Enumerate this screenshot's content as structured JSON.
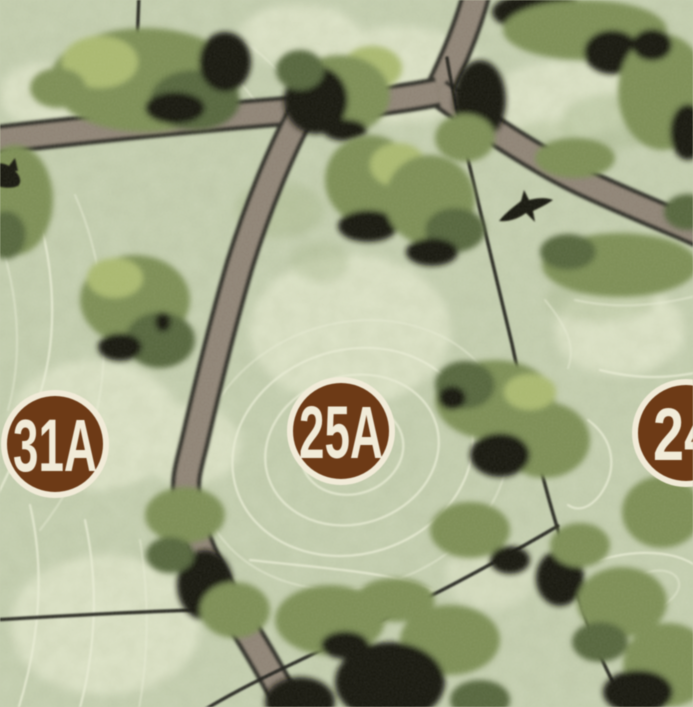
{
  "map": {
    "kind": "illustrated lot site plan",
    "lots": [
      {
        "id": "lot-31a",
        "label": "31A"
      },
      {
        "id": "lot-25a",
        "label": "25A"
      },
      {
        "id": "lot-24",
        "label": "24"
      }
    ],
    "features": {
      "bird_icon_count": 2,
      "road_segments": 4,
      "lot_boundary_lines": 4
    },
    "colors": {
      "background": "#c6d0b0",
      "background_light": "#dde3c6",
      "background_dark": "#a9b88c",
      "tree_olive": "#7b8d52",
      "tree_light": "#a9b86d",
      "tree_dark": "#54653a",
      "tree_black": "#15140c",
      "road_fill": "#8e8375",
      "road_edge": "#2f2d25",
      "contour": "#e8ebd1",
      "boundary": "#201f17",
      "badge_fill": "#6e3a15",
      "badge_ring": "#f1ebd7",
      "badge_text": "#f1ebd7"
    }
  }
}
